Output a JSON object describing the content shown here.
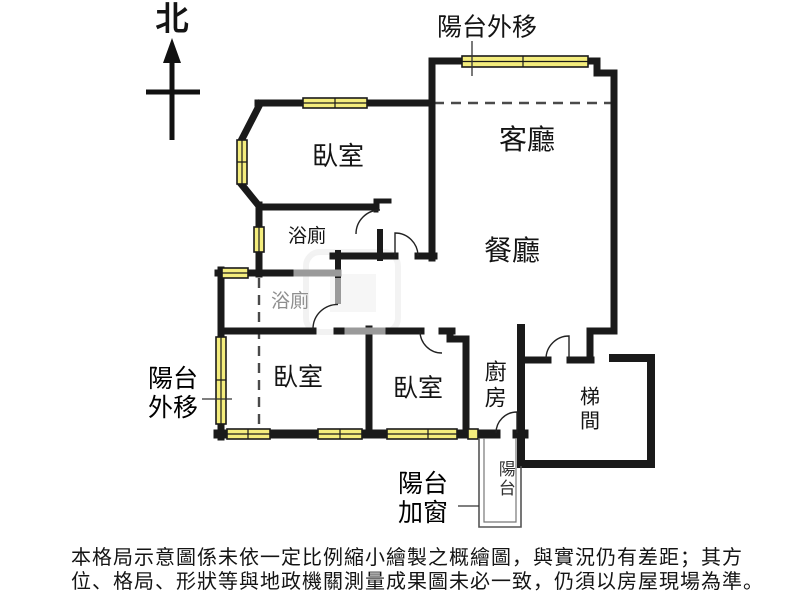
{
  "compass": {
    "north_label": "北"
  },
  "rooms": {
    "bedroom_top": "臥室",
    "bedroom_left": "臥室",
    "bedroom_mid": "臥室",
    "living_room": "客廳",
    "dining_room": "餐廳",
    "bathroom_upper": "浴廁",
    "bathroom_lower": "浴廁",
    "kitchen": "廚房",
    "stairwell": "梯間",
    "balcony": "陽台"
  },
  "annotations": {
    "balcony_ext_top": "陽台外移",
    "balcony_ext_left_line1": "陽台",
    "balcony_ext_left_line2": "外移",
    "balcony_added_window_line1": "陽台",
    "balcony_added_window_line2": "加窗"
  },
  "disclaimer": {
    "line1": "本格局示意圖係未依一定比例縮小繪製之概繪圖，與實況仍有差距；其方",
    "line2": "位、格局、形狀等與地政機關測量成果圖未必一致，仍須以房屋現場為準。"
  },
  "colors": {
    "wall": "#1a1a1a",
    "light_wall": "#9a9a9a",
    "window_fill": "#f4ed7d",
    "dashed_line": "#4a4a4a",
    "gray_label": "#8f8f8f"
  }
}
